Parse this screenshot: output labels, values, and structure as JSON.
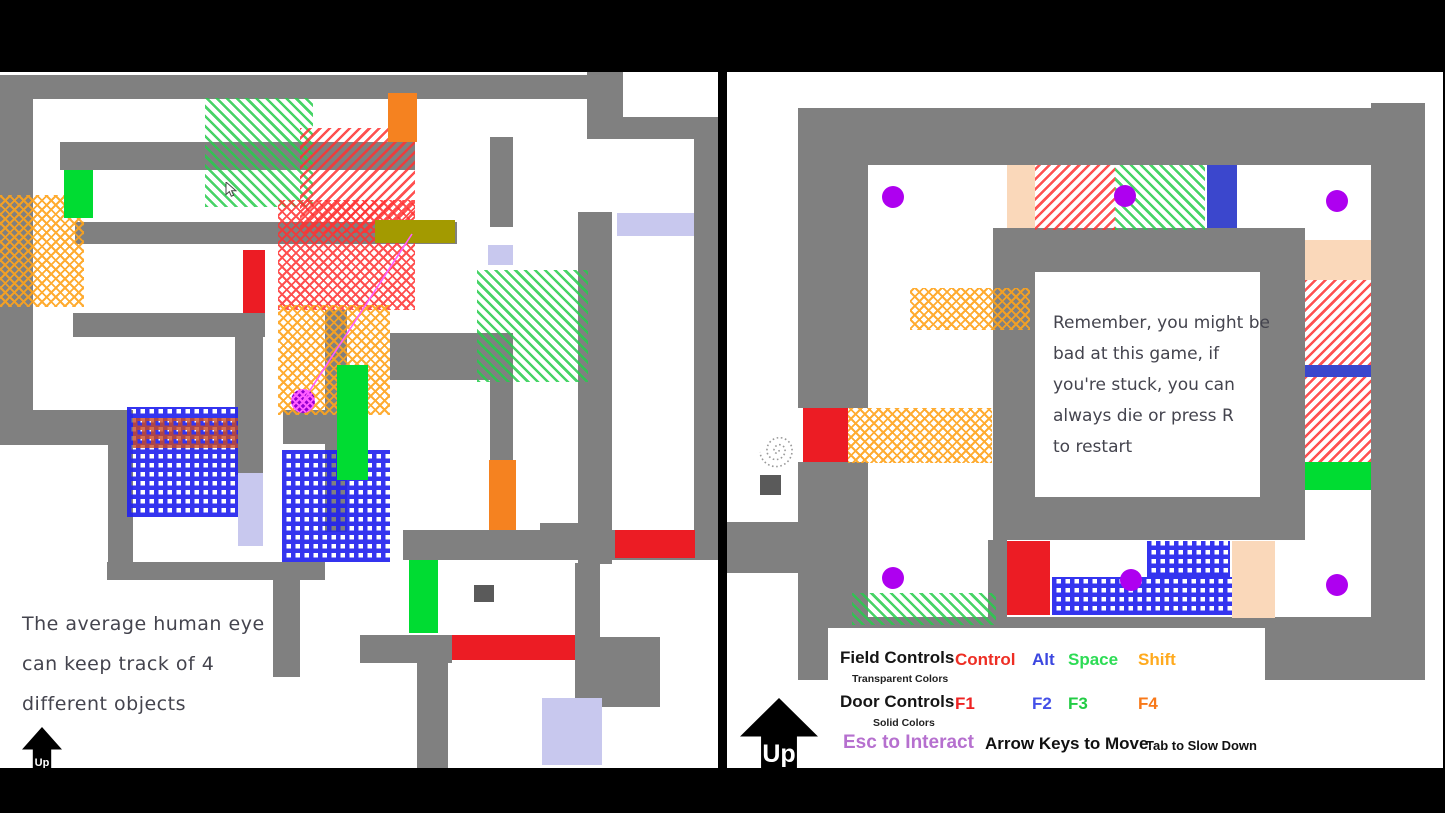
{
  "palette": {
    "wall": "#808080",
    "red": "#ec1c24",
    "green": "#00dc32",
    "orange": "#f58220",
    "blue": "#3b47cd",
    "peach": "#fad8ba",
    "lav": "#c8c8ee",
    "olive": "#a39a00",
    "dark": "#5a5a5a",
    "gdiag": "#27cc4c",
    "rdiag": "#ff3232",
    "odots": "#ffa41c",
    "bgrid": "#2323ee",
    "rgrid": "#cc4a22",
    "pdot": "#ae00f0",
    "magenta": "#ff5cff",
    "ink": "#44444e"
  },
  "left_panel": {
    "message_lines": [
      "The average human eye",
      "can keep track of 4",
      "different objects"
    ],
    "up_label": "Up",
    "walls": [
      [
        0,
        3,
        588,
        24
      ],
      [
        587,
        0,
        36,
        65
      ],
      [
        587,
        45,
        131,
        22
      ],
      [
        694,
        45,
        24,
        440
      ],
      [
        0,
        3,
        33,
        340
      ],
      [
        0,
        338,
        133,
        35
      ],
      [
        60,
        70,
        355,
        28
      ],
      [
        75,
        150,
        382,
        22
      ],
      [
        490,
        65,
        23,
        90
      ],
      [
        73,
        241,
        192,
        24
      ],
      [
        235,
        241,
        28,
        162
      ],
      [
        325,
        238,
        22,
        222
      ],
      [
        283,
        338,
        64,
        34
      ],
      [
        108,
        373,
        25,
        133
      ],
      [
        107,
        490,
        218,
        18
      ],
      [
        273,
        490,
        27,
        115
      ],
      [
        390,
        261,
        123,
        47
      ],
      [
        490,
        306,
        23,
        84
      ],
      [
        403,
        458,
        315,
        30
      ],
      [
        360,
        563,
        92,
        28
      ],
      [
        578,
        140,
        34,
        352
      ],
      [
        575,
        491,
        25,
        146
      ],
      [
        575,
        565,
        85,
        70
      ],
      [
        417,
        591,
        31,
        105
      ],
      [
        540,
        451,
        50,
        24
      ]
    ],
    "blocks": [
      [
        "f-gdiag",
        205,
        26,
        108,
        109
      ],
      [
        "f-rdiag",
        300,
        56,
        115,
        105
      ],
      [
        "f-rdots",
        278,
        128,
        137,
        110
      ],
      [
        "f-odots",
        0,
        123,
        84,
        112
      ],
      [
        "f-odots",
        278,
        233,
        112,
        110
      ],
      [
        "f-gdiag",
        477,
        198,
        111,
        112
      ],
      [
        "f-bgrid",
        127,
        335,
        111,
        110
      ],
      [
        "f-rgrid",
        133,
        346,
        105,
        30
      ],
      [
        "f-bgrid",
        282,
        378,
        108,
        112
      ],
      [
        "s-orange",
        388,
        21,
        29,
        49
      ],
      [
        "s-green",
        64,
        98,
        29,
        48
      ],
      [
        "s-red",
        243,
        178,
        22,
        63
      ],
      [
        "s-olive",
        375,
        148,
        80,
        23
      ],
      [
        "s-lav",
        488,
        173,
        25,
        20
      ],
      [
        "s-lav",
        617,
        141,
        77,
        23
      ],
      [
        "s-green",
        337,
        293,
        31,
        115
      ],
      [
        "s-orange",
        489,
        388,
        27,
        70
      ],
      [
        "s-lav",
        238,
        401,
        25,
        73
      ],
      [
        "s-red",
        615,
        458,
        80,
        28
      ],
      [
        "s-red",
        452,
        563,
        123,
        25
      ],
      [
        "s-green",
        409,
        488,
        29,
        73
      ],
      [
        "s-lav",
        542,
        626,
        60,
        67
      ],
      [
        "s-dark",
        474,
        513,
        20,
        17
      ]
    ],
    "player": {
      "x": 303,
      "y": 329,
      "r": 12
    },
    "aim_line": {
      "x1": 303,
      "y1": 329,
      "x2": 412,
      "y2": 162
    },
    "cursor": {
      "x": 225,
      "y": 110
    }
  },
  "right_panel": {
    "note_lines": [
      "Remember, you might be",
      "bad at this game, if",
      "you're stuck, you can",
      "always die or press R",
      "to restart"
    ],
    "up_label": "Up",
    "walls": [
      [
        71,
        36,
        627,
        57
      ],
      [
        644,
        31,
        54,
        577
      ],
      [
        71,
        36,
        70,
        300
      ],
      [
        71,
        390,
        70,
        218
      ],
      [
        71,
        545,
        627,
        63
      ],
      [
        0,
        450,
        71,
        51
      ],
      [
        266,
        156,
        312,
        44
      ],
      [
        266,
        156,
        42,
        312
      ],
      [
        533,
        156,
        45,
        312
      ],
      [
        266,
        425,
        312,
        43
      ],
      [
        261,
        468,
        19,
        77
      ]
    ],
    "blocks": [
      [
        "f-rdiag",
        308,
        93,
        80,
        65
      ],
      [
        "f-gdiag",
        388,
        93,
        90,
        65
      ],
      [
        "f-rdiag",
        578,
        208,
        66,
        85
      ],
      [
        "f-rdiag",
        578,
        305,
        66,
        85
      ],
      [
        "f-odots",
        183,
        216,
        120,
        42
      ],
      [
        "f-odots",
        121,
        336,
        144,
        55
      ],
      [
        "f-gdiag",
        125,
        521,
        144,
        32
      ],
      [
        "f-bgrid",
        420,
        469,
        83,
        36
      ],
      [
        "f-bgrid",
        325,
        505,
        180,
        38
      ],
      [
        "s-peach",
        280,
        93,
        28,
        63
      ],
      [
        "s-blue",
        480,
        93,
        30,
        63
      ],
      [
        "s-red",
        76,
        336,
        45,
        54
      ],
      [
        "s-peach",
        578,
        168,
        66,
        40
      ],
      [
        "s-blue",
        578,
        293,
        66,
        12
      ],
      [
        "s-green",
        578,
        390,
        66,
        28
      ],
      [
        "s-red",
        280,
        469,
        43,
        74
      ],
      [
        "s-peach",
        505,
        469,
        43,
        77
      ],
      [
        "s-dark",
        33,
        403,
        21,
        20
      ]
    ],
    "dots": [
      [
        166,
        125
      ],
      [
        398,
        124
      ],
      [
        610,
        129
      ],
      [
        166,
        506
      ],
      [
        404,
        508
      ],
      [
        610,
        513
      ]
    ],
    "spiral": {
      "x": 31,
      "y": 359
    },
    "controls": {
      "field_label": "Field Controls",
      "field_sub": "Transparent Colors",
      "field_keys": [
        {
          "label": "Control",
          "color": "#ee2e24"
        },
        {
          "label": "Alt",
          "color": "#3c47e0"
        },
        {
          "label": "Space",
          "color": "#2ddc55"
        },
        {
          "label": "Shift",
          "color": "#ffaa1e"
        }
      ],
      "door_label": "Door Controls",
      "door_sub": "Solid Colors",
      "door_keys": [
        {
          "label": "F1",
          "color": "#ee2222"
        },
        {
          "label": "F2",
          "color": "#4450e8"
        },
        {
          "label": "F3",
          "color": "#22cc44"
        },
        {
          "label": "F4",
          "color": "#f87818"
        }
      ],
      "esc_label": "Esc to Interact",
      "esc_color": "#b670cf",
      "move_label": "Arrow Keys to Move",
      "tab_label": "Tab to Slow Down"
    }
  }
}
